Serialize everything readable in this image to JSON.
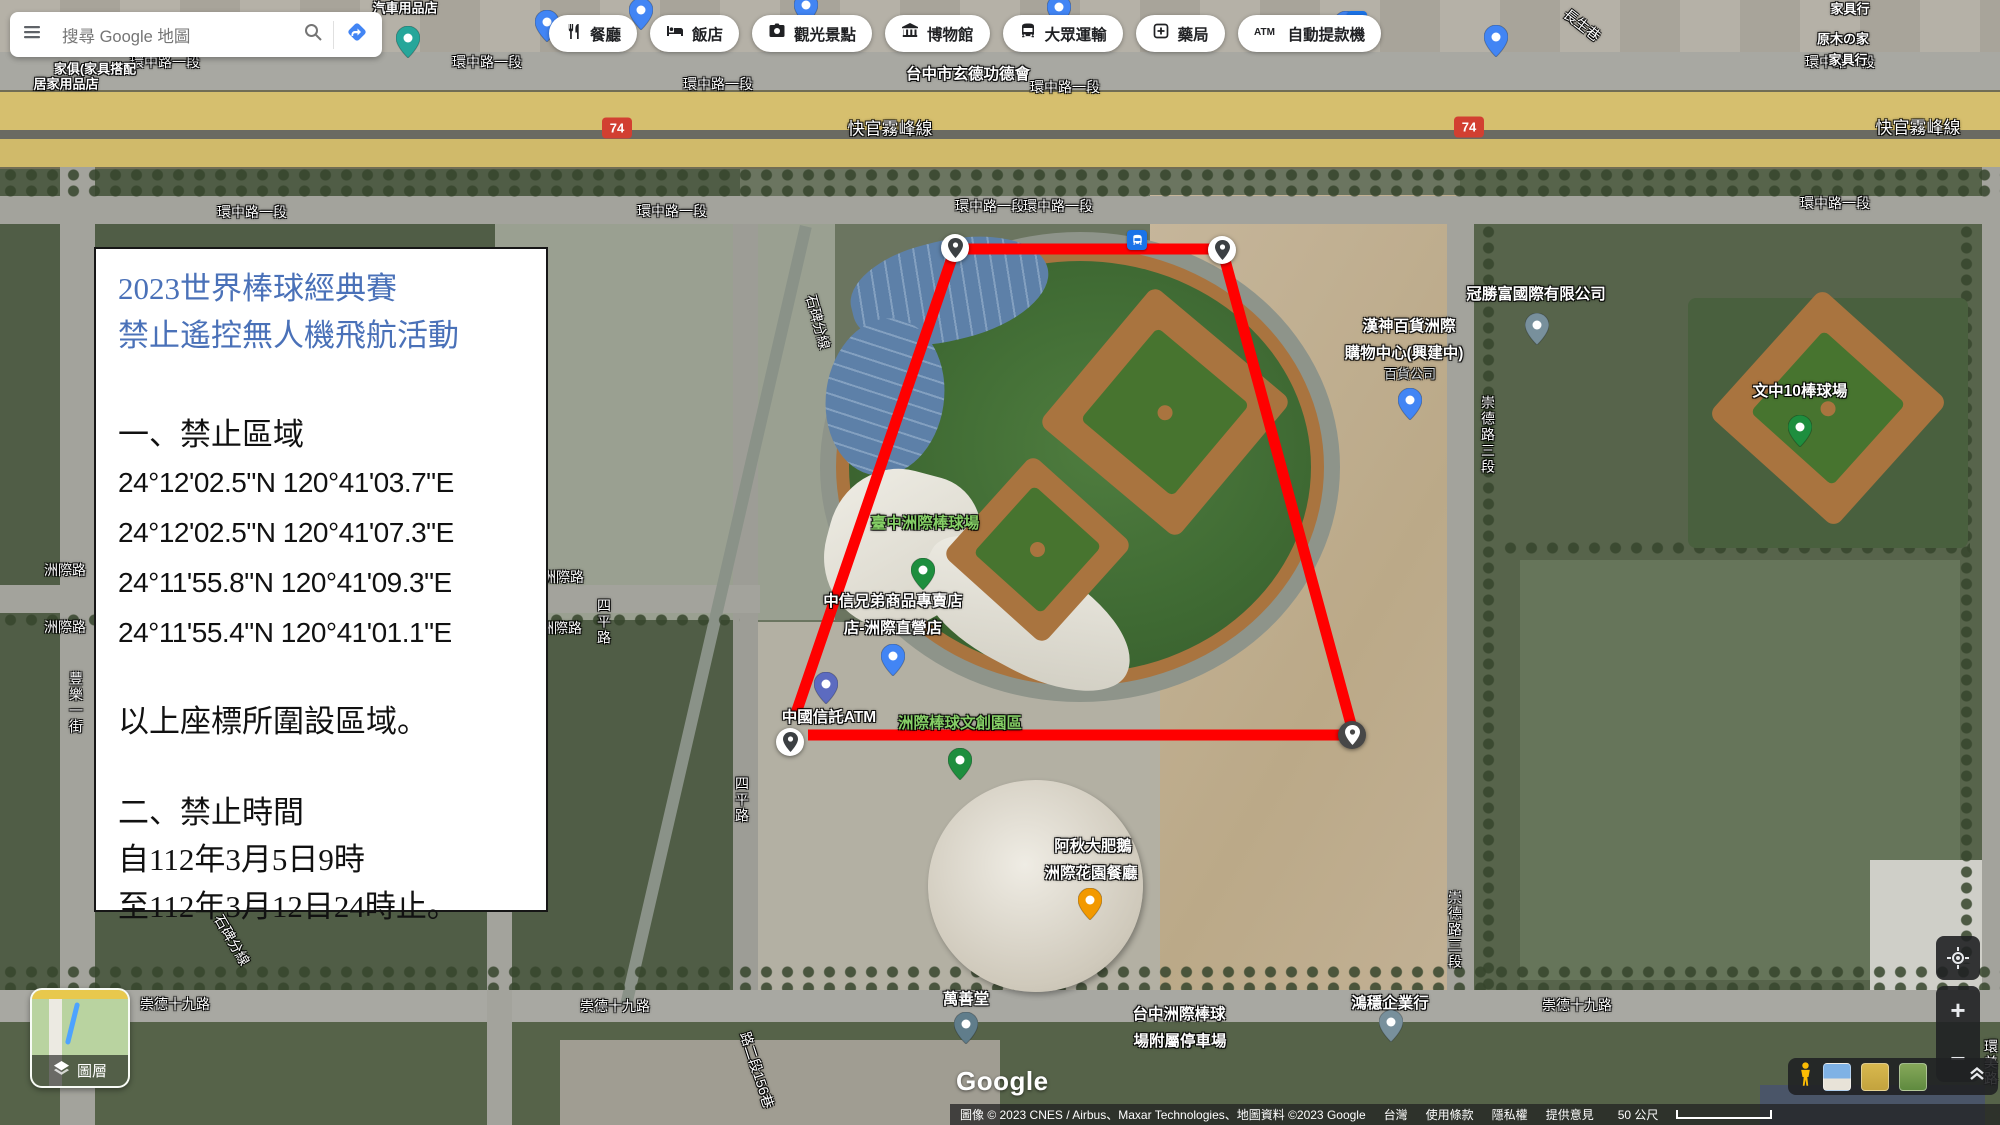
{
  "topbar": {
    "search_placeholder": "搜尋 Google 地圖",
    "chips": [
      {
        "icon": "restaurant-icon",
        "label": "餐廳"
      },
      {
        "icon": "hotel-icon",
        "label": "飯店"
      },
      {
        "icon": "attraction-icon",
        "label": "觀光景點"
      },
      {
        "icon": "museum-icon",
        "label": "博物館"
      },
      {
        "icon": "transit-icon",
        "label": "大眾運輸"
      },
      {
        "icon": "pharmacy-icon",
        "label": "藥局"
      },
      {
        "icon": "atm-icon",
        "label": "自動提款機"
      }
    ]
  },
  "notice_box": {
    "title_line1": "2023世界棒球經典賽",
    "title_line2": "禁止遙控無人機飛航活動",
    "section1_heading": "一、禁止區域",
    "coordinates": [
      "24°12'02.5\"N 120°41'03.7\"E",
      "24°12'02.5\"N 120°41'07.3\"E",
      "24°11'55.8\"N 120°41'09.3\"E",
      "24°11'55.4\"N 120°41'01.1\"E"
    ],
    "section1_note": "以上座標所圍設區域。",
    "section2_heading": "二、禁止時間",
    "time_from": "自112年3月5日9時",
    "time_to": "至112年3月12日24時止。"
  },
  "map": {
    "labels": [
      {
        "t": "環中路一段",
        "x": 165,
        "y": 62,
        "k": "road"
      },
      {
        "t": "環中路一段",
        "x": 487,
        "y": 62,
        "k": "road"
      },
      {
        "t": "環中路一段",
        "x": 718,
        "y": 84,
        "k": "road"
      },
      {
        "t": "環中路一段",
        "x": 1065,
        "y": 87,
        "k": "road"
      },
      {
        "t": "環中路一段",
        "x": 1840,
        "y": 62,
        "k": "road"
      },
      {
        "t": "環中路一段",
        "x": 252,
        "y": 212,
        "k": "road"
      },
      {
        "t": "環中路一段",
        "x": 672,
        "y": 211,
        "k": "road"
      },
      {
        "t": "環中路一段",
        "x": 990,
        "y": 206,
        "k": "road"
      },
      {
        "t": "環中路一段",
        "x": 1058,
        "y": 206,
        "k": "road"
      },
      {
        "t": "環中路一段",
        "x": 1835,
        "y": 203,
        "k": "road"
      },
      {
        "t": "快官霧峰線",
        "x": 890,
        "y": 127,
        "k": "road",
        "s": 17
      },
      {
        "t": "快官霧峰線",
        "x": 1918,
        "y": 126,
        "k": "road",
        "s": 17
      },
      {
        "t": "崇德十九路",
        "x": 175,
        "y": 1004,
        "k": "road"
      },
      {
        "t": "崇德十九路",
        "x": 615,
        "y": 1006,
        "k": "road"
      },
      {
        "t": "崇德十九路",
        "x": 1577,
        "y": 1005,
        "k": "road"
      },
      {
        "t": "洲際路",
        "x": 65,
        "y": 570,
        "k": "road"
      },
      {
        "t": "洲際路",
        "x": 65,
        "y": 627,
        "k": "road"
      },
      {
        "t": "洲際路",
        "x": 563,
        "y": 577,
        "k": "road"
      },
      {
        "t": "洲際路",
        "x": 561,
        "y": 628,
        "k": "road"
      },
      {
        "t": "四平路",
        "x": 604,
        "y": 622,
        "k": "road",
        "r": "v"
      },
      {
        "t": "四平路",
        "x": 742,
        "y": 800,
        "k": "road",
        "r": "v"
      },
      {
        "t": "崇德路三段",
        "x": 1488,
        "y": 435,
        "k": "road",
        "r": "v"
      },
      {
        "t": "崇德路三段",
        "x": 1455,
        "y": 930,
        "k": "road",
        "r": "v"
      },
      {
        "t": "石碑分線",
        "x": 818,
        "y": 322,
        "k": "road",
        "r": 75
      },
      {
        "t": "石碑分線",
        "x": 232,
        "y": 940,
        "k": "road",
        "r": 60
      },
      {
        "t": "路二段156巷",
        "x": 757,
        "y": 1070,
        "k": "road",
        "r": 72
      },
      {
        "t": "長生巷",
        "x": 1582,
        "y": 25,
        "k": "road",
        "r": 38
      },
      {
        "t": "豐樂一街",
        "x": 76,
        "y": 703,
        "k": "road",
        "r": "v"
      },
      {
        "t": "環美路",
        "x": 1991,
        "y": 1063,
        "k": "road",
        "r": "v"
      },
      {
        "t": "台中市玄德功德會",
        "x": 968,
        "y": 73,
        "k": "poi"
      },
      {
        "t": "臺中洲際棒球場",
        "x": 925,
        "y": 522,
        "k": "green"
      },
      {
        "t": "中信兄弟商品專賣店",
        "x": 893,
        "y": 600,
        "k": "poi"
      },
      {
        "t": "店-洲際直營店",
        "x": 893,
        "y": 627,
        "k": "poi"
      },
      {
        "t": "中國信託ATM",
        "x": 829,
        "y": 716,
        "k": "poi"
      },
      {
        "t": "洲際棒球文創園區",
        "x": 960,
        "y": 722,
        "k": "green"
      },
      {
        "t": "阿秋大肥鵝",
        "x": 1093,
        "y": 845,
        "k": "poi"
      },
      {
        "t": "洲際花園餐廳",
        "x": 1091,
        "y": 872,
        "k": "poi"
      },
      {
        "t": "萬善堂",
        "x": 966,
        "y": 998,
        "k": "poi"
      },
      {
        "t": "台中洲際棒球",
        "x": 1179,
        "y": 1013,
        "k": "poi"
      },
      {
        "t": "場附屬停車場",
        "x": 1180,
        "y": 1040,
        "k": "poi"
      },
      {
        "t": "鴻穩企業行",
        "x": 1390,
        "y": 1002,
        "k": "poi"
      },
      {
        "t": "冠勝富國際有限公司",
        "x": 1536,
        "y": 293,
        "k": "poi"
      },
      {
        "t": "漢神百貨洲際",
        "x": 1409,
        "y": 325,
        "k": "poi"
      },
      {
        "t": "購物中心(興建中)",
        "x": 1404,
        "y": 352,
        "k": "poi"
      },
      {
        "t": "百貨公司",
        "x": 1410,
        "y": 373,
        "k": "gray"
      },
      {
        "t": "文中10棒球場",
        "x": 1800,
        "y": 390,
        "k": "poi"
      },
      {
        "t": "居家用品店",
        "x": 66,
        "y": 83,
        "k": "poi",
        "s": 13
      },
      {
        "t": "家俱(家具搭配",
        "x": 95,
        "y": 68,
        "k": "poi",
        "s": 13
      },
      {
        "t": "汽車用品店",
        "x": 405,
        "y": 7,
        "k": "poi",
        "s": 13
      },
      {
        "t": "原木の家",
        "x": 1843,
        "y": 38,
        "k": "poi",
        "s": 13
      },
      {
        "t": "家具行",
        "x": 1848,
        "y": 59,
        "k": "poi",
        "s": 13
      },
      {
        "t": "家具行",
        "x": 1850,
        "y": 8,
        "k": "poi",
        "s": 13
      }
    ],
    "pins": [
      {
        "type": "teal",
        "x": 408,
        "y": 58
      },
      {
        "type": "shop",
        "x": 547,
        "y": 42
      },
      {
        "type": "shop",
        "x": 641,
        "y": 30
      },
      {
        "type": "shop",
        "x": 806,
        "y": 25
      },
      {
        "type": "shop",
        "x": 1059,
        "y": 27
      },
      {
        "type": "shop",
        "x": 1346,
        "y": 43
      },
      {
        "type": "shop",
        "x": 1496,
        "y": 57
      },
      {
        "type": "shop",
        "x": 893,
        "y": 676
      },
      {
        "type": "shop",
        "x": 1410,
        "y": 420
      },
      {
        "type": "green",
        "x": 923,
        "y": 590
      },
      {
        "type": "green",
        "x": 1800,
        "y": 447
      },
      {
        "type": "greenshop",
        "x": 960,
        "y": 780
      },
      {
        "type": "food",
        "x": 1090,
        "y": 920
      },
      {
        "type": "temple",
        "x": 966,
        "y": 1044
      },
      {
        "type": "gray",
        "x": 1537,
        "y": 345
      },
      {
        "type": "gray",
        "x": 1391,
        "y": 1042
      },
      {
        "type": "parking",
        "x": 826,
        "y": 704
      }
    ],
    "transit_icons": [
      {
        "x": 1137,
        "y": 240
      },
      {
        "x": 1357,
        "y": 21
      }
    ],
    "corner_markers": [
      {
        "x": 955,
        "y": 248,
        "variant": "light"
      },
      {
        "x": 1222,
        "y": 250,
        "variant": "light"
      },
      {
        "x": 1352,
        "y": 735,
        "variant": "dark"
      },
      {
        "x": 790,
        "y": 742,
        "variant": "light"
      }
    ],
    "zone_polyline": "795,716 955,249 1222,249 1352,728 1352,735 808,735",
    "highway_shields": [
      {
        "text": "74",
        "x": 617,
        "y": 128
      },
      {
        "text": "74",
        "x": 1469,
        "y": 127
      }
    ]
  },
  "controls": {
    "layers_label": "圖層",
    "zoom_in": "+",
    "zoom_out": "−"
  },
  "footer": {
    "google_logo": "Google",
    "attribution": "圖像 © 2023 CNES / Airbus、Maxar Technologies、地圖資料 ©2023 Google",
    "links": [
      "台灣",
      "使用條款",
      "隱私權",
      "提供意見"
    ],
    "scale_text": "50 公尺"
  },
  "colors": {
    "accent_blue": "#4285f4",
    "zone_red": "#ff0000",
    "notice_title_blue": "#4a71b8",
    "highway_yellow": "#d6bf6e",
    "shield_red": "#d23f31",
    "poi_green_label": "#85cf66",
    "pin_blue": "#4285f4",
    "pin_green": "#1e8e3e",
    "pin_orange": "#f29900",
    "pin_gray": "#78909c",
    "pin_slate": "#607d8b",
    "pin_indigo": "#5c6bc0",
    "pin_teal": "#26a69a"
  }
}
